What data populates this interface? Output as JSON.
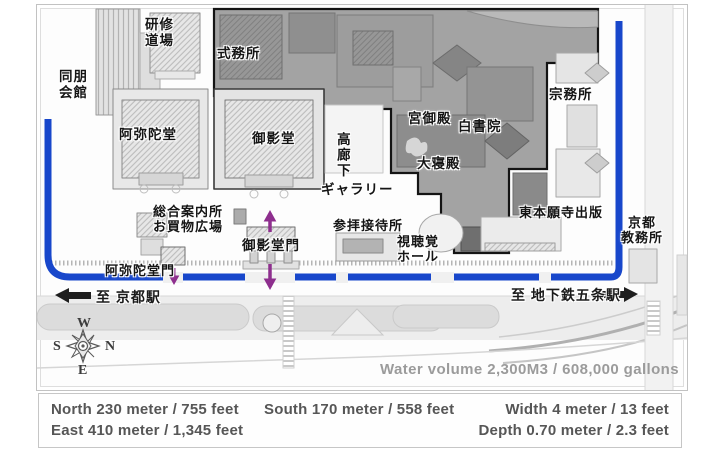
{
  "colors": {
    "moat": "#1847cb",
    "arrow_purple": "#8e2f8e",
    "dark_zone": "#a3a3a3",
    "road": "#ededed",
    "measure_text": "#565656",
    "muted_text": "#9b9b9b"
  },
  "map": {
    "water_volume": "Water volume 2,300M3 / 608,000 gallons",
    "compass": {
      "top": "W",
      "left": "S",
      "right": "N",
      "bottom": "E"
    },
    "stations": {
      "to_kyoto": "至 京都駅",
      "to_gojo": "至 地下鉄五条駅"
    },
    "labels": [
      {
        "name": "label-kenshu-dojo",
        "text": "研修\n道場",
        "x": 108,
        "y": 12,
        "center": true
      },
      {
        "name": "label-doho-kaikan",
        "text": "同朋\n会館",
        "x": 22,
        "y": 64,
        "center": true
      },
      {
        "name": "label-shikimusho",
        "text": "式務所",
        "x": 180,
        "y": 41
      },
      {
        "name": "label-amidado",
        "text": "阿弥陀堂",
        "x": 82,
        "y": 122
      },
      {
        "name": "label-goeido",
        "text": "御影堂",
        "x": 215,
        "y": 126
      },
      {
        "name": "label-takaroka",
        "text": "高廊下",
        "x": 297,
        "y": 127,
        "vertical": true
      },
      {
        "name": "label-gallery",
        "text": "ギャラリー",
        "x": 284,
        "y": 177
      },
      {
        "name": "label-miya-goten",
        "text": "宮御殿",
        "x": 371,
        "y": 106
      },
      {
        "name": "label-hakushoin",
        "text": "白書院",
        "x": 421,
        "y": 114
      },
      {
        "name": "label-daishinden",
        "text": "大寝殿",
        "x": 380,
        "y": 151
      },
      {
        "name": "label-shumusho",
        "text": "宗務所",
        "x": 512,
        "y": 82
      },
      {
        "name": "label-shuppan",
        "text": "東本願寺出版",
        "x": 482,
        "y": 200,
        "size": 13
      },
      {
        "name": "label-kyoto-kyomusho",
        "text": "京都\n教務所",
        "x": 584,
        "y": 210,
        "center": true,
        "size": 13
      },
      {
        "name": "label-sogo-annaisho",
        "text": "総合案内所\nお買物広場",
        "x": 116,
        "y": 199,
        "size": 13
      },
      {
        "name": "label-sanpai-settaisho",
        "text": "参拝接待所",
        "x": 296,
        "y": 213,
        "size": 13
      },
      {
        "name": "label-shichokaku-hall",
        "text": "視聴覚\nホール",
        "x": 360,
        "y": 229,
        "center": true,
        "size": 13
      },
      {
        "name": "label-goeido-mon",
        "text": "御影堂門",
        "x": 205,
        "y": 233
      },
      {
        "name": "label-amidado-mon",
        "text": "阿弥陀堂門",
        "x": 68,
        "y": 258,
        "size": 13
      }
    ]
  },
  "measurements": {
    "north": "North 230 meter / 755 feet",
    "east": "East 410 meter / 1,345 feet",
    "south": "South 170 meter / 558 feet",
    "width": "Width 4 meter / 13 feet",
    "depth": "Depth 0.70 meter / 2.3 feet"
  }
}
